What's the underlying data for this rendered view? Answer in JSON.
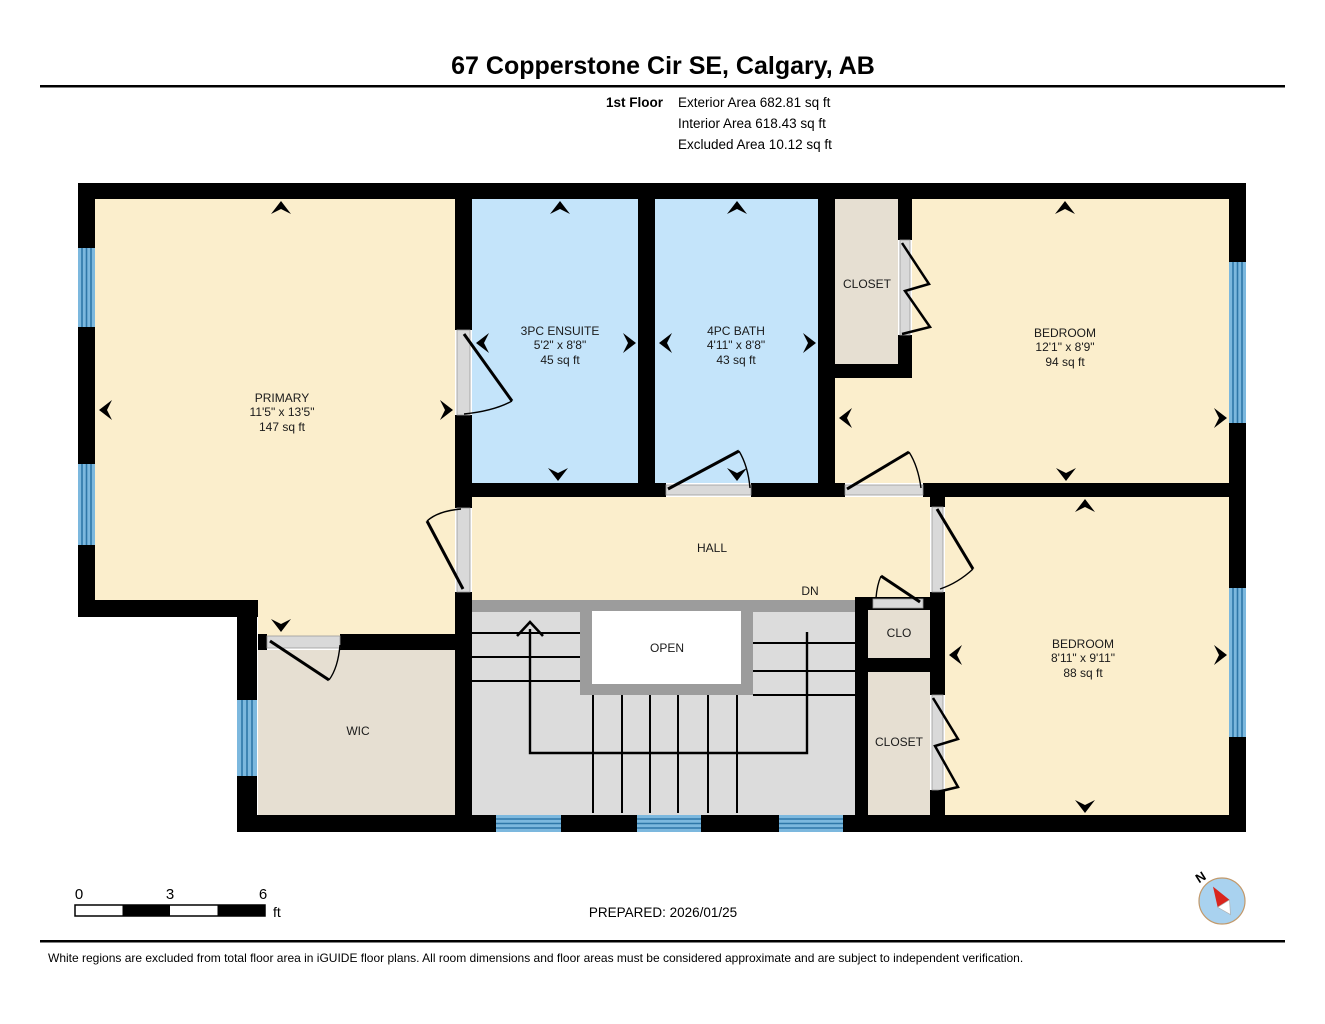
{
  "header": {
    "address": "67 Copperstone Cir SE, Calgary, AB",
    "floor_label": "1st Floor",
    "exterior_area": "Exterior Area 682.81 sq ft",
    "interior_area": "Interior Area 618.43 sq ft",
    "excluded_area": "Excluded Area 10.12 sq ft"
  },
  "rooms": {
    "primary": {
      "name": "PRIMARY",
      "dims": "11'5\" x 13'5\"",
      "area": "147 sq ft"
    },
    "ensuite": {
      "name": "3PC ENSUITE",
      "dims": "5'2\" x 8'8\"",
      "area": "45 sq ft"
    },
    "bath": {
      "name": "4PC BATH",
      "dims": "4'11\" x 8'8\"",
      "area": "43 sq ft"
    },
    "closet_top": {
      "name": "CLOSET"
    },
    "bedroom_top": {
      "name": "BEDROOM",
      "dims": "12'1\" x 8'9\"",
      "area": "94 sq ft"
    },
    "hall": {
      "name": "HALL"
    },
    "stairs": {
      "down_label": "DN",
      "open_label": "OPEN"
    },
    "clo": {
      "name": "CLO"
    },
    "closet_bottom": {
      "name": "CLOSET"
    },
    "wic": {
      "name": "WIC"
    },
    "bedroom_bottom": {
      "name": "BEDROOM",
      "dims": "8'11\" x 9'11\"",
      "area": "88 sq ft"
    }
  },
  "scale_bar": {
    "ticks": [
      "0",
      "3",
      "6"
    ],
    "unit": "ft"
  },
  "prepared": "PREPARED: 2026/01/25",
  "compass": {
    "north_label": "N"
  },
  "footer": "White regions are excluded from total floor area in iGUIDE floor plans. All room dimensions and floor areas must be considered approximate and are subject to independent verification.",
  "colors": {
    "room": "#FBEECC",
    "wet_room": "#C4E4FA",
    "closet": "#E6DFD2",
    "window": "#7CB8DE",
    "window_line": "#2E77A8",
    "wall": "#000000",
    "stairs": "#DCDCDC",
    "stair_trim": "#9C9C9C",
    "compass_red": "#D9251D"
  }
}
